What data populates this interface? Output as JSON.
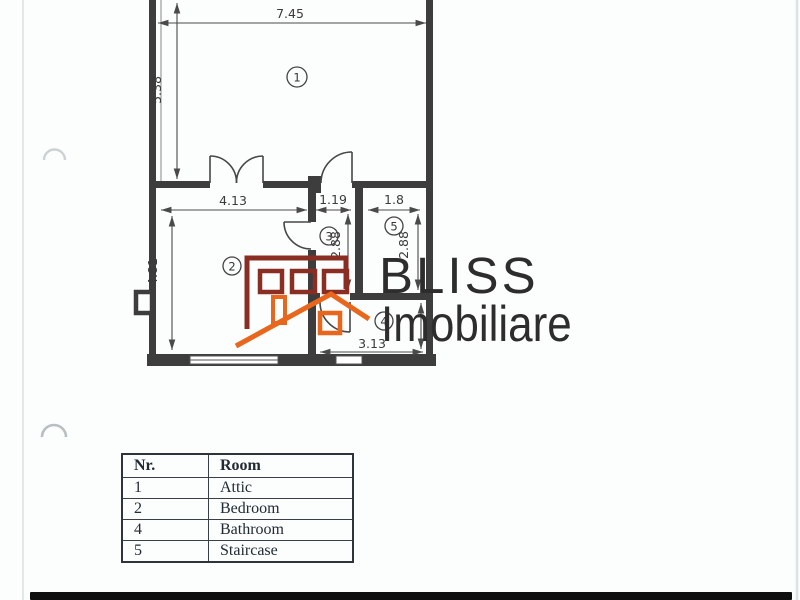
{
  "scan": {
    "background": "#fcfdfd",
    "line_color": "#3d3d3d",
    "edge_bar_color": "#0f0f0f"
  },
  "watermark": {
    "title": "BLISS",
    "subtitle": "Imobiliare",
    "text_color": "#2d2d2d",
    "house_color": "#8a2e24",
    "roof_color": "#e8671c"
  },
  "plan": {
    "room_labels": {
      "room1": "1",
      "room2": "2",
      "room3": "3",
      "room4": "4",
      "room5": "5"
    },
    "dimensions": {
      "room1_width": "7.45",
      "room1_height": "5.38",
      "room2_width": "4.13",
      "room2_height": "4.81",
      "room3_width": "1.19",
      "room3_height": "2.88",
      "room5_width": "1.8",
      "room5_height": "2.88",
      "room4_width": "3.13"
    }
  },
  "legend_table": {
    "headers": [
      "Nr.",
      "Room"
    ],
    "rows": [
      {
        "nr": "1",
        "room": "Attic"
      },
      {
        "nr": "2",
        "room": "Bedroom"
      },
      {
        "nr": "4",
        "room": "Bathroom"
      },
      {
        "nr": "5",
        "room": "Staircase"
      }
    ]
  }
}
